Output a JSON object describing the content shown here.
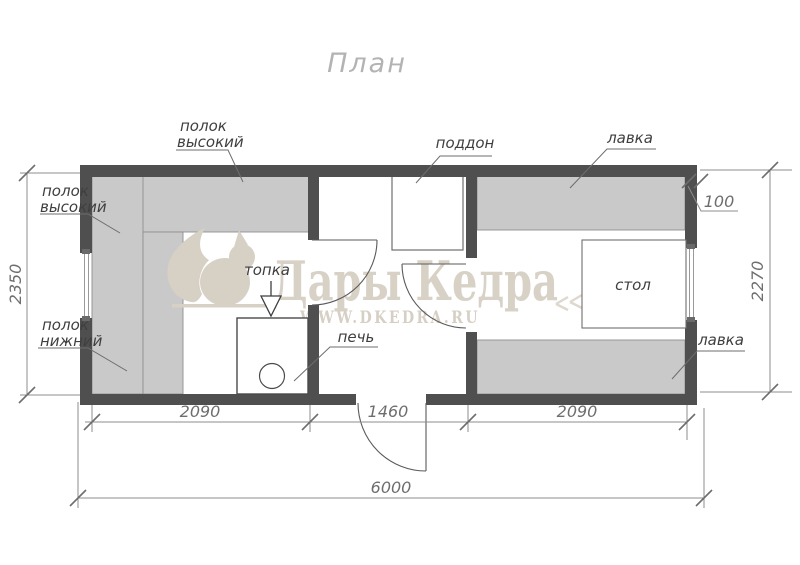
{
  "title": "План",
  "watermark": {
    "brand": "Дары Кедра",
    "website": "WWW.DKEDRA.RU"
  },
  "plan": {
    "labels": {
      "shelf_high_left_line1": "полок",
      "shelf_high_left_line2": "высокий",
      "shelf_high_top_line1": "полок",
      "shelf_high_top_line2": "высокий",
      "shelf_low_left_line1": "полок",
      "shelf_low_left_line2": "нижний",
      "pallet": "поддон",
      "bench_top": "лавка",
      "bench_bottom": "лавка",
      "firebox": "топка",
      "stove": "печь",
      "table": "стол"
    },
    "dimensions": {
      "height_left_mm": "2350",
      "height_right_mm": "2270",
      "wall_thickness_mm": "100",
      "room_left_mm": "2090",
      "room_middle_mm": "1460",
      "room_right_mm": "2090",
      "total_width_mm": "6000"
    },
    "colors": {
      "wall": "#4f4f4f",
      "bench_fill": "#c9c9c9",
      "watermark": "#d7d0c5",
      "line": "#6d6d6d"
    }
  }
}
